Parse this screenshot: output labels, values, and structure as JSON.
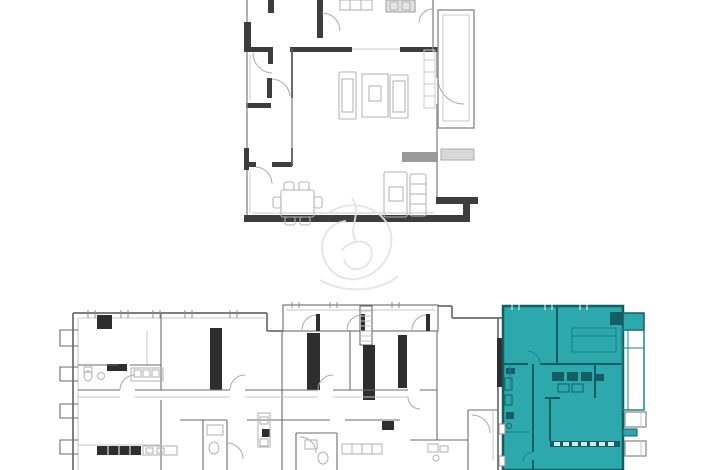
{
  "page": {
    "background": "#ffffff",
    "content_type": "floor-plan-image"
  },
  "colors": {
    "wall_dark": "#3d3d3d",
    "wall_black": "#2e2e2e",
    "line_mid": "#8f8f8f",
    "line_light": "#c9c9c9",
    "highlight_fill": "#2da9ae",
    "highlight_wall": "#135e63",
    "highlight_mid": "#1b868c",
    "watermark": "#e3e3e3"
  },
  "plans": {
    "detail_plan": {
      "label": "unit-detail-floor-plan",
      "features": [
        "living-sofa-set",
        "coffee-table",
        "dining-table-6-chairs",
        "lounge-seating",
        "balcony",
        "kitchen-counter",
        "wardrobe"
      ]
    },
    "floor_plate": {
      "label": "building-floor-plate",
      "features": [
        "service-shafts",
        "stair-core",
        "corridor",
        "left-balcony-tabs",
        "top-gallery-doors",
        "bathroom-pods",
        "kitchen-counters"
      ]
    },
    "highlighted_unit": {
      "label": "selected-unit",
      "fill": "#2da9ae",
      "position": "right-end-of-floor-plate"
    }
  },
  "watermark": {
    "label": "brand-watermark"
  }
}
